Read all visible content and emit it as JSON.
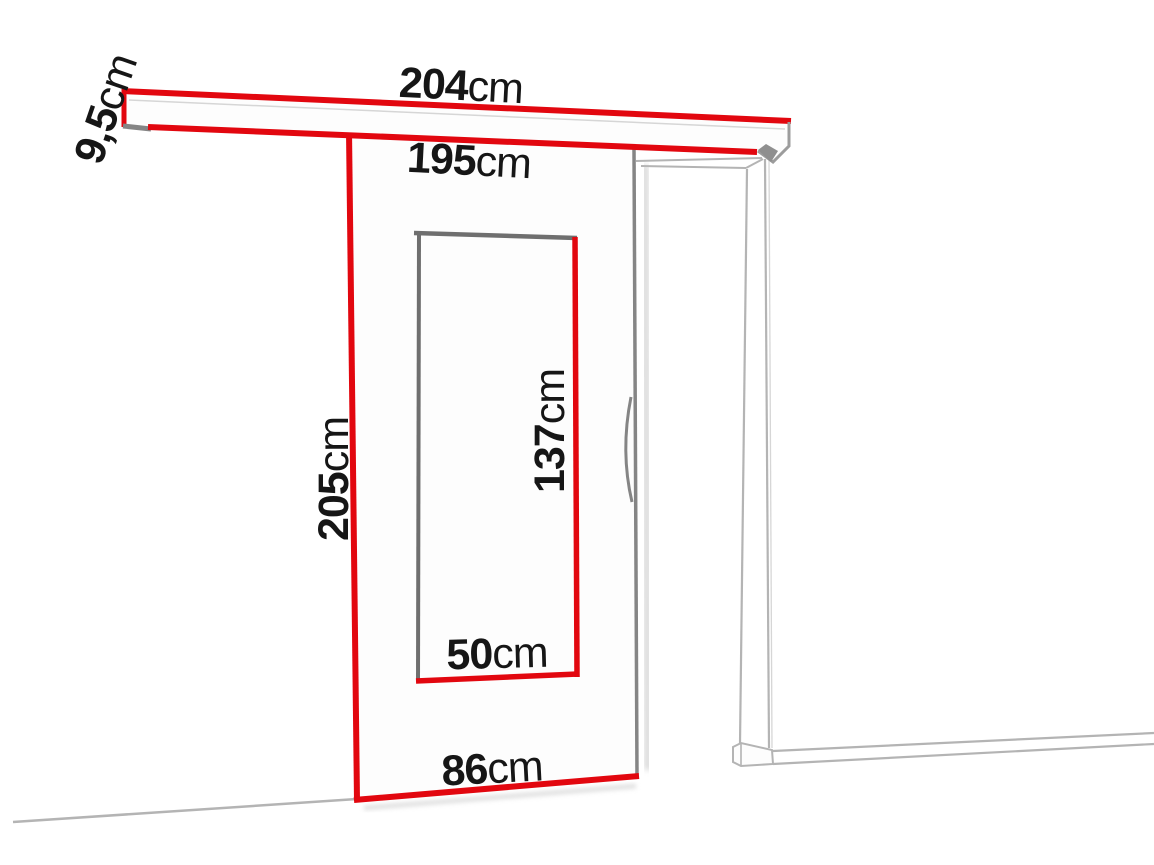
{
  "diagram": {
    "kind": "sliding-door-dimension-drawing"
  },
  "colors": {
    "accent_red": "#e2070f",
    "door_edge_gray": "#858585",
    "glass_edge_gray": "#6f6f6f",
    "frame_line_gray": "#b4b4b4",
    "text_color": "#161616",
    "background": "#ffffff"
  },
  "labels": {
    "rail_length": {
      "value": "204",
      "unit": "cm"
    },
    "rail_height": {
      "value": "9,5",
      "unit": "cm"
    },
    "clear_width": {
      "value": "195",
      "unit": "cm"
    },
    "door_height": {
      "value": "205",
      "unit": "cm"
    },
    "glass_height": {
      "value": "137",
      "unit": "cm"
    },
    "glass_width": {
      "value": "50",
      "unit": "cm"
    },
    "door_width": {
      "value": "86",
      "unit": "cm"
    }
  }
}
